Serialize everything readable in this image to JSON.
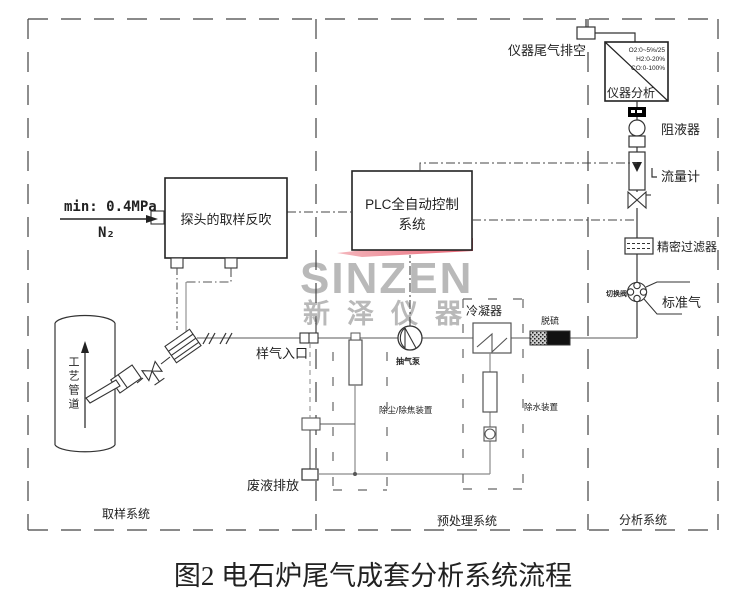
{
  "title": "图2 电石炉尾气成套分析系统流程",
  "watermark": {
    "brand": "SINZEN",
    "brand_cn": "新泽仪器"
  },
  "colors": {
    "accent_red": "#e2475a",
    "watermark_gray": "#b9b9b9",
    "line": "#333333",
    "gas_line": "#7a7a7a"
  },
  "sections": {
    "sampling": "取样系统",
    "pretreatment": "预处理系统",
    "analysis": "分析系统"
  },
  "analyzer": {
    "label": "仪器分析",
    "ranges": [
      "O2:0~5%/25",
      "H2:0-20%",
      "CO:0-100%"
    ]
  },
  "labels": {
    "exhaust_vent": "仪器尾气排空",
    "liquid_trap": "阻液器",
    "flow_meter": "流量计",
    "precision_filter": "精密过滤器",
    "switch_valve": "切换阀",
    "standard_gas": "标准气",
    "plc_line1": "PLC全自动控制",
    "plc_line2": "系统",
    "probe_box": "探头的取样反吹",
    "n2_min_pressure": "min: 0.4MPa",
    "n2": "N₂",
    "sample_inlet": "样气入口",
    "pump": "抽气泵",
    "condenser": "冷凝器",
    "desulfurizer": "脱硫",
    "dust_removal": "除尘/除焦装置",
    "water_removal": "除水装置",
    "waste_discharge": "废液排放",
    "pipe_flow_tag": "工艺管道"
  }
}
